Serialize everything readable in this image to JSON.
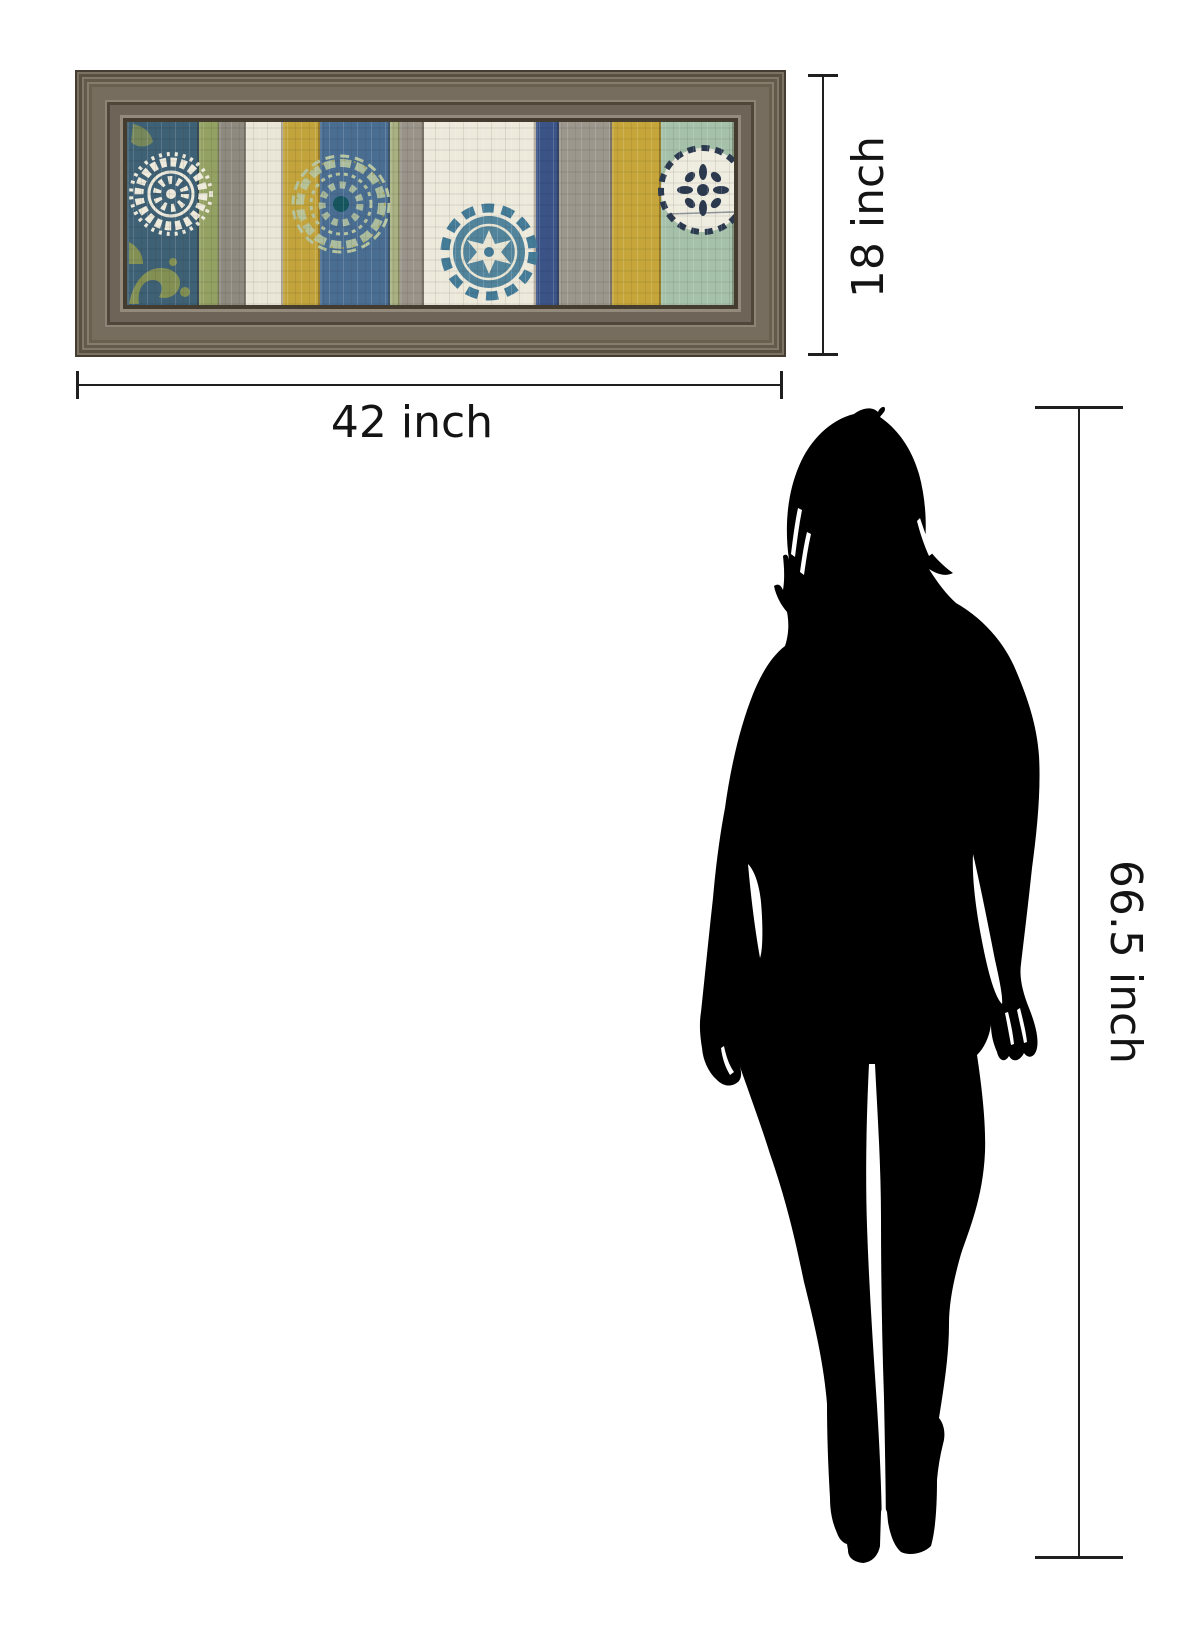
{
  "page": {
    "background": "#ffffff"
  },
  "product": {
    "name": "framed striped suzani panel wall art",
    "frame_wood_color": "#6f6557"
  },
  "dimensions": {
    "art_width": {
      "value": "42 inch"
    },
    "art_height": {
      "value": "18 inch"
    },
    "person_height": {
      "value": "66.5 inch"
    }
  },
  "annotation": {
    "line_color": "#1f1f1f",
    "text_color": "#141414"
  },
  "silhouette": {
    "color": "#000000",
    "description": "standing woman silhouette for scale"
  },
  "artwork": {
    "planks": [
      {
        "color": "#3e6175",
        "width": 71
      },
      {
        "color": "#93a163",
        "width": 20
      },
      {
        "color": "#8f8a80",
        "width": 27
      },
      {
        "color": "#eae6d7",
        "width": 37
      },
      {
        "color": "#c2a33c",
        "width": 36
      },
      {
        "color": "#4a6d92",
        "width": 70
      },
      {
        "color": "#a9b183",
        "width": 10
      },
      {
        "color": "#99938a",
        "width": 24
      },
      {
        "color": "#ede9db",
        "width": 111
      },
      {
        "color": "#3a5488",
        "width": 22
      },
      {
        "color": "#9c978d",
        "width": 53
      },
      {
        "color": "#c6a63a",
        "width": 49
      },
      {
        "color": "#a5c1aa",
        "width": 72
      }
    ],
    "medallions": [
      "white-suzani",
      "celadon-lace",
      "blue-suzani",
      "navy-rosette"
    ],
    "accent_colors": {
      "teal_dot": "#16565f",
      "olive": "#9aa04a",
      "navy": "#2c3a50",
      "cream": "#efece0",
      "blue_motif": "#447b97"
    }
  }
}
